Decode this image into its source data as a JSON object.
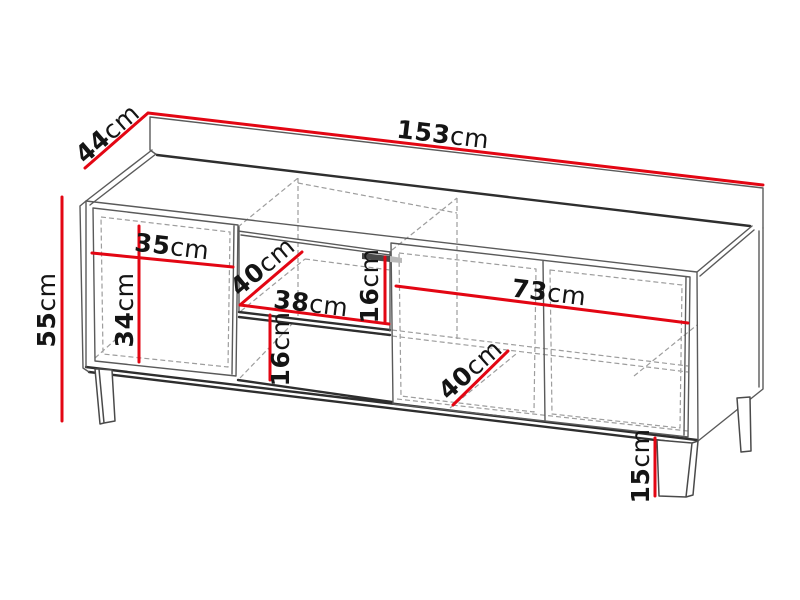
{
  "diagram": {
    "subject": "tv-stand-dimension-drawing",
    "accent_color": "#e30613",
    "outline_color": "#2e2e2e",
    "hidden_line_color": "#9d9d9d",
    "dimensions": {
      "total_width": {
        "num": "153",
        "unit": "cm"
      },
      "depth": {
        "num": "44",
        "unit": "cm"
      },
      "total_height": {
        "num": "55",
        "unit": "cm"
      },
      "left_door_width": {
        "num": "35",
        "unit": "cm"
      },
      "left_inner_height": {
        "num": "34",
        "unit": "cm"
      },
      "upper_shelf_depth": {
        "num": "40",
        "unit": "cm"
      },
      "middle_shelf_width": {
        "num": "38",
        "unit": "cm"
      },
      "upper_shelf_height": {
        "num": "16",
        "unit": "cm"
      },
      "lower_shelf_height": {
        "num": "16",
        "unit": "cm"
      },
      "right_door_width": {
        "num": "73",
        "unit": "cm"
      },
      "lower_shelf_depth": {
        "num": "40",
        "unit": "cm"
      },
      "leg_height": {
        "num": "15",
        "unit": "cm"
      }
    }
  }
}
